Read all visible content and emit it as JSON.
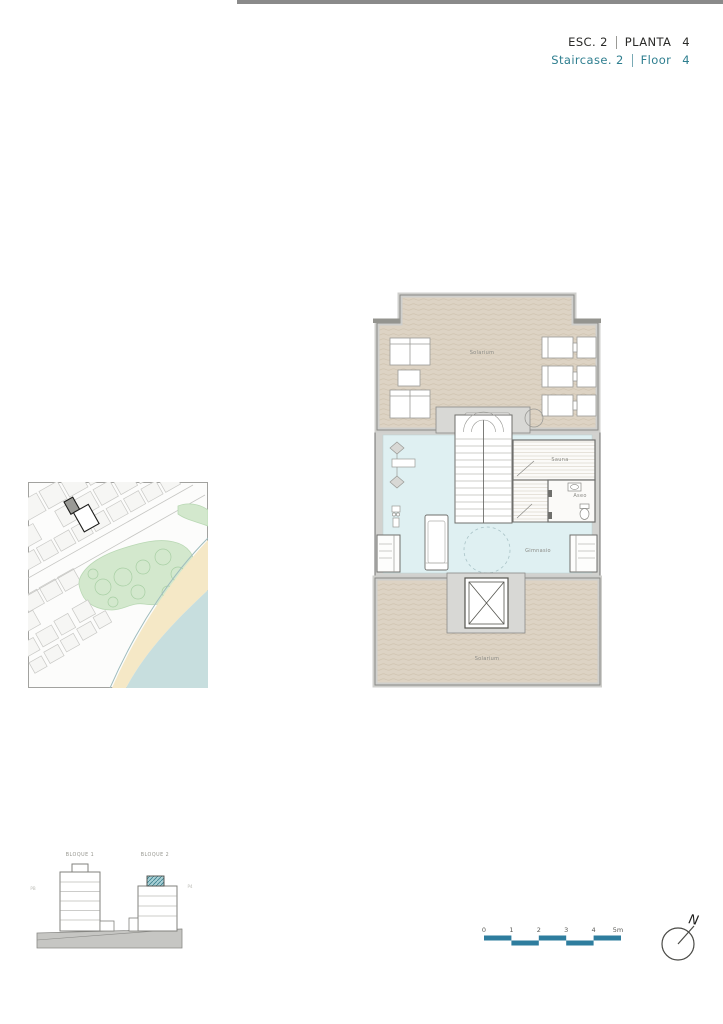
{
  "header": {
    "esc_label": "ESC. 2",
    "planta_label": "PLANTA",
    "planta_number": "4",
    "staircase_label": "Staircase. 2",
    "floor_label": "Floor",
    "floor_number": "4"
  },
  "floor_plan": {
    "solarium_top": "Solarium",
    "sauna": "Sauna",
    "aseo": "Aseo",
    "gimnasio": "Gimnasio",
    "solarium_bottom": "Solarium"
  },
  "elevation": {
    "bloque1": "BLOQUE 1",
    "bloque2": "BLOQUE 2",
    "left_level": "PB",
    "right_level": "P4"
  },
  "scale_bar": {
    "ticks": [
      "0",
      "1",
      "2",
      "3",
      "4"
    ],
    "end_label": "5m"
  },
  "compass": {
    "north_label": "N"
  },
  "colors": {
    "accent_teal": "#2e7e8f",
    "scale_bar_teal": "#2e7d9e",
    "solarium_fill": "#ddd3c4",
    "gym_fill": "#dff0f2",
    "wall_gray": "#d2d2cf",
    "outline_gray": "#6f6f6c",
    "map_green": "#d3e8cd",
    "map_sand": "#f5e8c6",
    "map_sea": "#c7dede",
    "highlight_teal": "#a9d0d5",
    "top_bar_gray": "#8a8a8a"
  }
}
